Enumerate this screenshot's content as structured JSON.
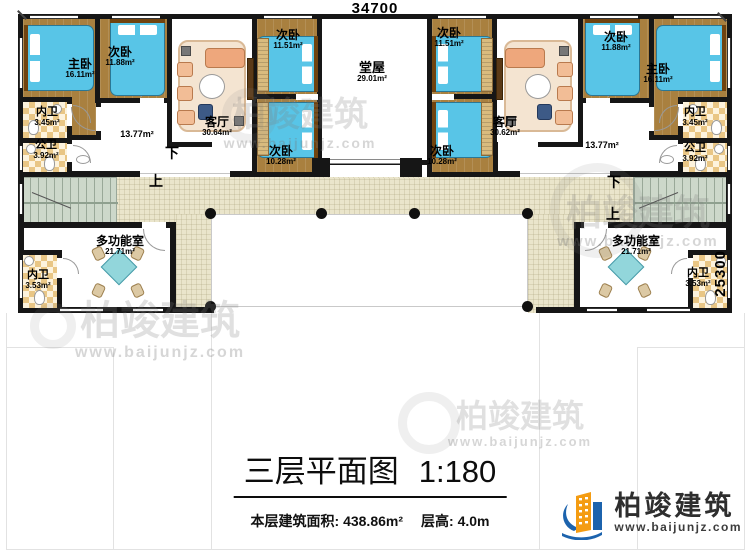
{
  "dimensions": {
    "width": "34700",
    "depth": "25300"
  },
  "stairs": {
    "down": "下",
    "up": "上"
  },
  "rooms": {
    "master_l": {
      "name": "主卧",
      "area": "16.11m²"
    },
    "master_r": {
      "name": "主卧",
      "area": "16.11m²"
    },
    "bed1188_l": {
      "name": "次卧",
      "area": "11.88m²"
    },
    "bed1188_r": {
      "name": "次卧",
      "area": "11.88m²"
    },
    "bed1151_l": {
      "name": "次卧",
      "area": "11.51m²"
    },
    "bed1151_r": {
      "name": "次卧",
      "area": "11.51m²"
    },
    "bed1028_l": {
      "name": "次卧",
      "area": "10.28m²"
    },
    "bed1028_r": {
      "name": "次卧",
      "area": "10.28m²"
    },
    "living_l": {
      "name": "客厅",
      "area": "30.64m²"
    },
    "living_r": {
      "name": "客厅",
      "area": "30.62m²"
    },
    "hall": {
      "name": "堂屋",
      "area": "29.01m²"
    },
    "bath_in_tl": {
      "name": "内卫",
      "area": "3.45m²"
    },
    "bath_in_tr": {
      "name": "内卫",
      "area": "3.45m²"
    },
    "bath_pub_tl": {
      "name": "公卫",
      "area": "3.92m²"
    },
    "bath_pub_tr": {
      "name": "公卫",
      "area": "3.92m²"
    },
    "bath_in_bl": {
      "name": "内卫",
      "area": "3.53m²"
    },
    "bath_in_br": {
      "name": "内卫",
      "area": "3.53m²"
    },
    "multi_l": {
      "name": "多功能室",
      "area": "21.71m²"
    },
    "multi_r": {
      "name": "多功能室",
      "area": "21.71m²"
    },
    "corridor_l": {
      "area": "13.77m²"
    },
    "corridor_r": {
      "area": "13.77m²"
    }
  },
  "title_block": {
    "title": "三层平面图",
    "scale": "1:180",
    "area_label": "本层建筑面积: ",
    "area_value": "438.86m²",
    "height_label": "层高: ",
    "height_value": "4.0m"
  },
  "logo": {
    "brand": "柏竣建筑",
    "url": "www.baijunjz.com"
  },
  "watermark": {
    "brand": "柏竣建筑",
    "url": "www.baijunjz.com"
  }
}
